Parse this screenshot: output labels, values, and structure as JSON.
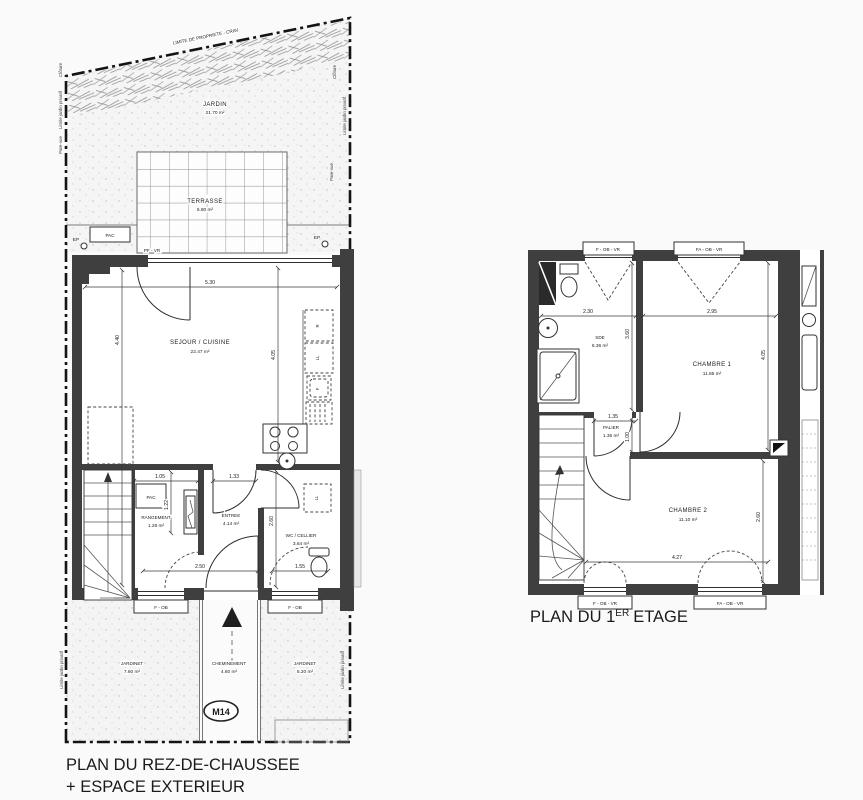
{
  "meta": {
    "ink": "#1c1c1c",
    "wall_color": "#3f3f3f",
    "background": "#fafafa"
  },
  "gf": {
    "title1": "PLAN DU REZ-DE-CHAUSSEE",
    "title2": "+ ESPACE EXTERIEUR",
    "boundary_label": "LIMITE DE PROPRIETE - CRAV",
    "cloture": "Clôture",
    "limite_jardin": "Limite jardin privatif",
    "parevue": "Pare-vue",
    "ep": "EP",
    "pac": "PAC",
    "window_top": "PF - VR",
    "window_fob": "F - OB",
    "marker": "M14",
    "jardin_name": "JARDIN",
    "jardin_area": "21.70 m²",
    "terrasse_name": "TERRASSE",
    "terrasse_area": "6.80 m²",
    "sejour_name": "SEJOUR / CUISINE",
    "sejour_area": "22.47 m²",
    "rangement_name": "RANGEMENT",
    "rangement_area": "1.28 m²",
    "entree_name": "ENTREE",
    "entree_area": "4.14 m²",
    "wc_name": "WC / CELLIER",
    "wc_area": "3.64 m²",
    "jardinet_l_name": "JARDINET",
    "jardinet_l_area": "7.60 m²",
    "chem_name": "CHEMINEMENT",
    "chem_area": "4.60 m²",
    "jardinet_r_name": "JARDINET",
    "jardinet_r_area": "5.20 m²",
    "appl_r": "R",
    "appl_ll": "LL",
    "appl_f": "F",
    "appl_ll_wc": "LL",
    "d530": "5.30",
    "d440": "4.40",
    "d405": "4.05",
    "d105": "1.05",
    "d122": "1.22",
    "d133": "1.33",
    "d250": "2.50",
    "d260": "2.60",
    "d155": "1.55"
  },
  "ff": {
    "title_pre": "PLAN DU 1",
    "title_sup": "ER",
    "title_post": "ETAGE",
    "window_fobvr": "F - OB - VR",
    "window_faobvr": "FA - OB - VR",
    "sde_name": "SDE",
    "sde_area": "6.36 m²",
    "ch1_name": "CHAMBRE 1",
    "ch1_area": "11.85 m²",
    "palier_name": "PALIER",
    "palier_area": "1.35 m²",
    "ch2_name": "CHAMBRE 2",
    "ch2_area": "11.10 m²",
    "d230": "2.30",
    "d295": "2.95",
    "d360": "3.60",
    "d405": "4.05",
    "d135": "1.35",
    "d100": "1.00",
    "d427": "4.27",
    "d260": "2.60"
  }
}
